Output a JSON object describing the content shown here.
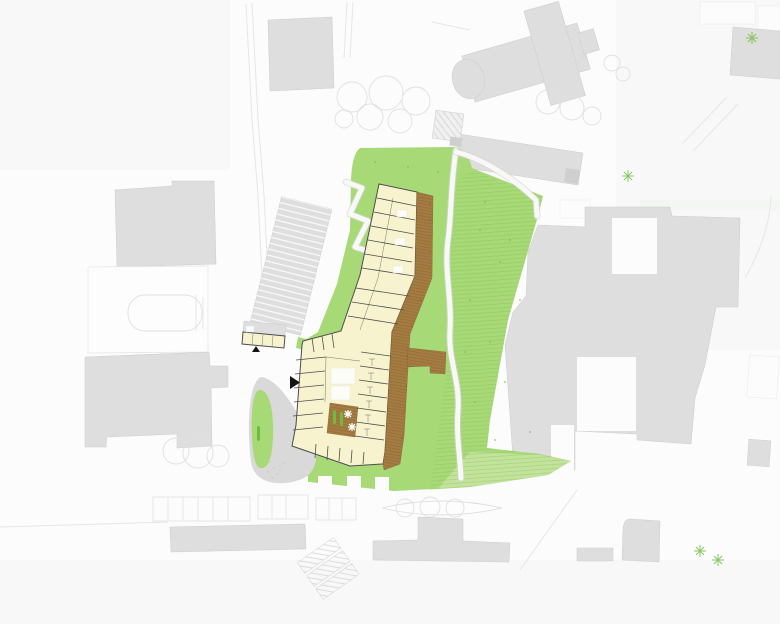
{
  "canvas": {
    "width": 780,
    "height": 624
  },
  "document": {
    "kind": "architectural-site-plan",
    "visible_text": "none"
  },
  "features": {
    "main_building": "main-building-rooms",
    "access_deck": "access-deck",
    "deck_spur": "deck-spur-bridge",
    "courtyard_terrace": "courtyard-terrace",
    "annex": "annex-building",
    "site_green": "site-green-area",
    "terraced_lawn": "terraced-lawn-hatch",
    "footpath": "winding-footpath",
    "ramp": "switchback-ramp",
    "traffic_island": "teardrop-green-island",
    "entrance_markers": "entrance-arrow-icons",
    "context_buildings": "context-building-footprints",
    "church": "church-building",
    "trees": "tree-canopy-outlines",
    "parking": "parking-stall-rows",
    "sheds": "hatched-shed-row"
  },
  "colors": {
    "background": "#fcfcfc",
    "plate": "#f3f4f3",
    "context-building": "#dedede",
    "context-building-dark": "#cfcfcf",
    "context-building-outline": "#cccccc",
    "white-building": "#fdfdfd",
    "site-green": "#a8d977",
    "site-green-light": "#c3e29c",
    "green-hatch": "#84bf55",
    "plant-green": "#6fbc3f",
    "deck-brown": "#a57c41",
    "deck-edge": "#8a6531",
    "room-yellow": "#f7f3cf",
    "wall-dark": "#4d4d4d",
    "path-gray": "#d6d6d6",
    "faint-line": "#e6e6e6",
    "tree-outline": "#e0e0e0",
    "island-gray": "#d9d9d9",
    "marker-black": "#141414",
    "white": "#ffffff"
  }
}
